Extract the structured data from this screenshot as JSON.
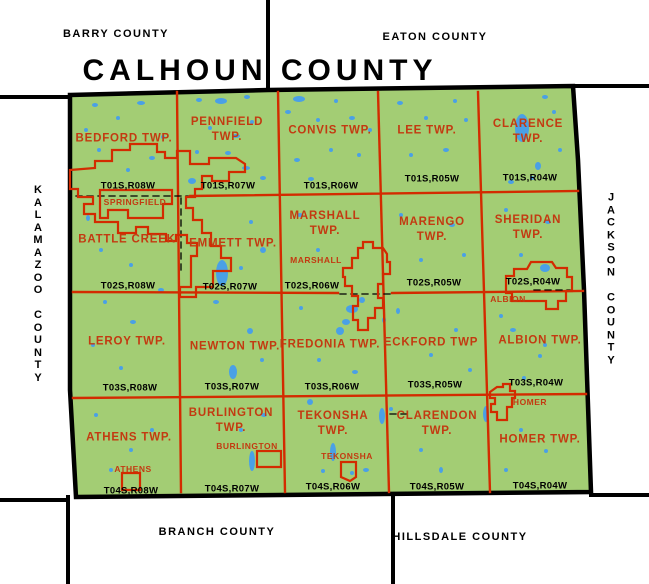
{
  "palette": {
    "background": "#FFFFFF",
    "land": "#A3CD74",
    "water": "#4AA0E6",
    "grid_red": "#D32B00",
    "label_red": "#C33A11",
    "line_black": "#000000"
  },
  "title": "CALHOUN COUNTY",
  "neighbors": {
    "northwest": "BARRY COUNTY",
    "northeast": "EATON COUNTY",
    "west": "KALAMAZOO COUNTY",
    "east": "JACKSON COUNTY",
    "south": "BRANCH COUNTY",
    "southeast": "HILLSDALE COUNTY"
  },
  "map": {
    "county_outline": "70,95 268,90 573,86 578,160 584,290 591,492 76,497 70,390",
    "black_lines": [
      [
        268,
        0,
        268,
        90
      ],
      [
        0,
        97,
        70,
        97
      ],
      [
        573,
        86,
        649,
        86
      ],
      [
        0,
        500,
        68,
        500
      ],
      [
        68,
        497,
        68,
        584
      ],
      [
        393,
        494,
        393,
        584
      ],
      [
        591,
        495,
        649,
        495
      ]
    ],
    "red_lines": [
      [
        177,
        92,
        181,
        492
      ],
      [
        278,
        92,
        285,
        492
      ],
      [
        378,
        92,
        389,
        492
      ],
      [
        478,
        92,
        490,
        492
      ],
      [
        190,
        196,
        578,
        191
      ],
      [
        73,
        292,
        338,
        293
      ],
      [
        392,
        293,
        583,
        291
      ],
      [
        73,
        398,
        586,
        394
      ]
    ],
    "dashed_lines": [
      [
        76,
        196,
        188,
        196
      ],
      [
        181,
        198,
        181,
        270
      ],
      [
        534,
        290,
        570,
        290
      ],
      [
        340,
        294,
        390,
        294
      ],
      [
        390,
        414,
        412,
        414
      ]
    ],
    "lakes": [
      [
        95,
        105,
        3,
        2
      ],
      [
        118,
        118,
        2,
        2
      ],
      [
        141,
        103,
        4,
        2
      ],
      [
        99,
        150,
        2,
        2
      ],
      [
        152,
        158,
        3,
        2
      ],
      [
        128,
        170,
        2,
        2
      ],
      [
        163,
        137,
        2,
        2
      ],
      [
        86,
        130,
        2,
        2
      ],
      [
        199,
        100,
        3,
        2
      ],
      [
        221,
        101,
        6,
        3
      ],
      [
        247,
        97,
        3,
        2
      ],
      [
        210,
        128,
        2,
        2
      ],
      [
        236,
        136,
        4,
        2
      ],
      [
        197,
        152,
        2,
        2
      ],
      [
        228,
        153,
        3,
        2
      ],
      [
        252,
        122,
        2,
        2
      ],
      [
        246,
        168,
        4,
        2
      ],
      [
        192,
        181,
        4,
        3
      ],
      [
        263,
        178,
        3,
        2
      ],
      [
        299,
        99,
        6,
        3
      ],
      [
        288,
        112,
        3,
        2
      ],
      [
        318,
        120,
        2,
        2
      ],
      [
        336,
        101,
        2,
        2
      ],
      [
        352,
        118,
        3,
        2
      ],
      [
        297,
        160,
        3,
        2
      ],
      [
        331,
        150,
        2,
        2
      ],
      [
        359,
        155,
        2,
        2
      ],
      [
        311,
        179,
        3,
        2
      ],
      [
        370,
        130,
        2,
        2
      ],
      [
        400,
        103,
        3,
        2
      ],
      [
        426,
        118,
        2,
        2
      ],
      [
        455,
        101,
        2,
        2
      ],
      [
        411,
        155,
        2,
        2
      ],
      [
        446,
        150,
        3,
        2
      ],
      [
        466,
        120,
        2,
        2
      ],
      [
        522,
        128,
        7,
        14
      ],
      [
        545,
        97,
        3,
        2
      ],
      [
        554,
        112,
        2,
        2
      ],
      [
        538,
        166,
        3,
        4
      ],
      [
        532,
        178,
        2,
        2
      ],
      [
        511,
        182,
        3,
        2
      ],
      [
        560,
        150,
        2,
        2
      ],
      [
        88,
        218,
        2,
        3
      ],
      [
        101,
        250,
        2,
        2
      ],
      [
        131,
        265,
        2,
        2
      ],
      [
        222,
        273,
        6,
        13
      ],
      [
        161,
        290,
        3,
        2
      ],
      [
        251,
        222,
        2,
        2
      ],
      [
        263,
        250,
        3,
        3
      ],
      [
        241,
        268,
        2,
        2
      ],
      [
        300,
        215,
        3,
        2
      ],
      [
        318,
        250,
        2,
        2
      ],
      [
        352,
        309,
        6,
        4
      ],
      [
        346,
        322,
        4,
        3
      ],
      [
        362,
        300,
        3,
        3
      ],
      [
        401,
        215,
        2,
        2
      ],
      [
        452,
        225,
        3,
        2
      ],
      [
        421,
        260,
        2,
        2
      ],
      [
        464,
        255,
        2,
        2
      ],
      [
        506,
        210,
        2,
        2
      ],
      [
        548,
        222,
        3,
        2
      ],
      [
        545,
        268,
        5,
        4
      ],
      [
        521,
        255,
        2,
        2
      ],
      [
        105,
        302,
        2,
        2
      ],
      [
        133,
        322,
        3,
        2
      ],
      [
        93,
        345,
        2,
        2
      ],
      [
        121,
        368,
        2,
        2
      ],
      [
        216,
        302,
        3,
        2
      ],
      [
        250,
        331,
        3,
        3
      ],
      [
        233,
        372,
        4,
        7
      ],
      [
        262,
        360,
        2,
        2
      ],
      [
        301,
        308,
        2,
        2
      ],
      [
        340,
        331,
        4,
        4
      ],
      [
        319,
        360,
        2,
        2
      ],
      [
        384,
        320,
        2,
        3
      ],
      [
        355,
        372,
        3,
        2
      ],
      [
        398,
        311,
        2,
        3
      ],
      [
        431,
        355,
        2,
        2
      ],
      [
        456,
        330,
        2,
        2
      ],
      [
        470,
        370,
        2,
        2
      ],
      [
        501,
        316,
        2,
        2
      ],
      [
        513,
        330,
        3,
        2
      ],
      [
        540,
        356,
        2,
        2
      ],
      [
        524,
        378,
        2,
        2
      ],
      [
        545,
        345,
        2,
        2
      ],
      [
        96,
        415,
        2,
        2
      ],
      [
        131,
        450,
        2,
        2
      ],
      [
        111,
        470,
        2,
        2
      ],
      [
        152,
        430,
        2,
        2
      ],
      [
        252,
        461,
        3,
        10
      ],
      [
        241,
        430,
        2,
        2
      ],
      [
        264,
        415,
        3,
        2
      ],
      [
        310,
        402,
        3,
        3
      ],
      [
        333,
        452,
        3,
        9
      ],
      [
        323,
        471,
        2,
        2
      ],
      [
        352,
        473,
        2,
        2
      ],
      [
        366,
        470,
        3,
        2
      ],
      [
        391,
        409,
        2,
        2
      ],
      [
        421,
        450,
        2,
        2
      ],
      [
        441,
        470,
        2,
        3
      ],
      [
        382,
        416,
        3,
        8
      ],
      [
        486,
        414,
        3,
        8
      ],
      [
        521,
        430,
        2,
        2
      ],
      [
        546,
        451,
        2,
        2
      ],
      [
        506,
        470,
        2,
        2
      ]
    ],
    "townships": [
      {
        "id": "bedford",
        "name": "BEDFORD TWP.",
        "x": 124,
        "y": 139,
        "tr": "T01S,R08W",
        "trx": 128,
        "try": 186
      },
      {
        "id": "pennfield",
        "name": "PENNFIELD\nTWP.",
        "x": 227,
        "y": 130,
        "tr": "T01S,R07W",
        "trx": 228,
        "try": 186
      },
      {
        "id": "convis",
        "name": "CONVIS TWP.",
        "x": 330,
        "y": 131,
        "tr": "T01S,R06W",
        "trx": 331,
        "try": 186
      },
      {
        "id": "lee",
        "name": "LEE TWP.",
        "x": 427,
        "y": 131,
        "tr": "T01S,R05W",
        "trx": 432,
        "try": 179
      },
      {
        "id": "clarence",
        "name": "CLARENCE\nTWP.",
        "x": 528,
        "y": 132,
        "tr": "T01S,R04W",
        "trx": 530,
        "try": 178
      },
      {
        "id": "battle-creek",
        "name": "BATTLE CREEK",
        "x": 127,
        "y": 240,
        "tr": "T02S,R08W",
        "trx": 128,
        "try": 286
      },
      {
        "id": "emmett",
        "name": "EMMETT TWP.",
        "x": 233,
        "y": 244,
        "tr": "T02S,R07W",
        "trx": 230,
        "try": 287
      },
      {
        "id": "marshall-twp",
        "name": "MARSHALL\nTWP.",
        "x": 325,
        "y": 224,
        "tr": "T02S,R06W",
        "trx": 312,
        "try": 286
      },
      {
        "id": "marengo",
        "name": "MARENGO\nTWP.",
        "x": 432,
        "y": 230,
        "tr": "T02S,R05W",
        "trx": 434,
        "try": 283
      },
      {
        "id": "sheridan",
        "name": "SHERIDAN\nTWP.",
        "x": 528,
        "y": 228,
        "tr": "T02S,R04W",
        "trx": 533,
        "try": 282
      },
      {
        "id": "leroy",
        "name": "LEROY TWP.",
        "x": 127,
        "y": 342,
        "tr": "T03S,R08W",
        "trx": 130,
        "try": 388
      },
      {
        "id": "newton",
        "name": "NEWTON TWP.",
        "x": 235,
        "y": 347,
        "tr": "T03S,R07W",
        "trx": 232,
        "try": 387
      },
      {
        "id": "fredonia",
        "name": "FREDONIA TWP.",
        "x": 330,
        "y": 345,
        "tr": "T03S,R06W",
        "trx": 332,
        "try": 387
      },
      {
        "id": "eckford",
        "name": "ECKFORD TWP",
        "x": 431,
        "y": 343,
        "tr": "T03S,R05W",
        "trx": 435,
        "try": 385
      },
      {
        "id": "albion-twp",
        "name": "ALBION TWP.",
        "x": 540,
        "y": 341,
        "tr": "T03S,R04W",
        "trx": 536,
        "try": 383
      },
      {
        "id": "athens-twp",
        "name": "ATHENS TWP.",
        "x": 129,
        "y": 438,
        "tr": "T04S,R08W",
        "trx": 131,
        "try": 491
      },
      {
        "id": "burlington-twp",
        "name": "BURLINGTON\nTWP.",
        "x": 231,
        "y": 421,
        "tr": "T04S,R07W",
        "trx": 232,
        "try": 489
      },
      {
        "id": "tekonsha-twp",
        "name": "TEKONSHA\nTWP.",
        "x": 333,
        "y": 424,
        "tr": "T04S,R06W",
        "trx": 333,
        "try": 487
      },
      {
        "id": "clarendon",
        "name": "CLARENDON\nTWP.",
        "x": 437,
        "y": 424,
        "tr": "T04S,R05W",
        "trx": 437,
        "try": 487
      },
      {
        "id": "homer-twp",
        "name": "HOMER TWP.",
        "x": 540,
        "y": 440,
        "tr": "T04S,R04W",
        "trx": 540,
        "try": 486
      }
    ],
    "cities": [
      {
        "id": "battle-creek-city",
        "label": "",
        "x": 0,
        "y": 0,
        "outline": "M70,170 L95,168 95,161 112,161 112,150 130,150 130,144 157,144 157,152 165,152 165,158 177,158 177,151 190,151 190,164 209,164 209,158 236,158 245,164 245,172 229,172 229,181 212,181 212,176 202,176 202,189 195,189 195,197 186,197 186,208 193,208 193,220 202,220 202,233 211,233 211,246 221,246 221,258 231,258 231,271 213,271 213,287 196,287 196,297 180,297 180,287 191,287 191,256 197,256 197,243 187,243 187,235 176,235 176,241 166,241 166,234 148,234 148,227 136,227 136,233 118,233 118,222 95,222 95,214 84,214 84,204 93,204 93,197 78,197 78,189 70,189 Z"
      },
      {
        "id": "springfield",
        "label": "SPRINGFIELD",
        "x": 135,
        "y": 202,
        "outline": "M100,190 L172,190 172,204 163,204 163,218 128,218 128,210 108,210 108,218 100,218 Z"
      },
      {
        "id": "marshall-city",
        "label": "MARSHALL",
        "x": 316,
        "y": 260,
        "outline": "M363,242 L373,242 373,248 383,248 387,254 387,262 390,262 390,274 383,274 383,284 378,284 378,298 383,298 383,308 375,308 375,318 368,318 368,330 358,330 358,320 353,320 353,306 358,306 358,296 352,296 352,286 345,286 345,277 343,277 343,268 352,268 352,258 358,258 358,248 363,248 Z"
      },
      {
        "id": "albion-city",
        "label": "ALBION",
        "x": 508,
        "y": 299,
        "outline": "M506,285 L506,276 514,276 514,269 527,269 531,262 552,262 556,268 567,268 567,277 572,277 572,291 566,291 566,301 558,301 558,309 546,309 546,301 512,301 512,293 506,293 Z"
      },
      {
        "id": "homer-village",
        "label": "HOMER",
        "x": 530,
        "y": 402,
        "outline": "M490,392 L497,387 503,387 503,384 510,384 510,391 515,391 515,398 512,398 512,407 507,407 507,420 497,420 497,412 491,412 491,404 495,404 495,398 490,398 Z"
      },
      {
        "id": "burlington-village",
        "label": "BURLINGTON",
        "x": 247,
        "y": 446,
        "outline": "M257,451 L281,451 281,467 257,467 Z"
      },
      {
        "id": "tekonsha-village",
        "label": "TEKONSHA",
        "x": 347,
        "y": 456,
        "outline": "M341,462 L356,462 356,477 350,481 341,477 Z"
      },
      {
        "id": "athens-village",
        "label": "ATHENS",
        "x": 133,
        "y": 469,
        "outline": "M122,473 L140,473 140,490 122,490 Z"
      }
    ]
  }
}
